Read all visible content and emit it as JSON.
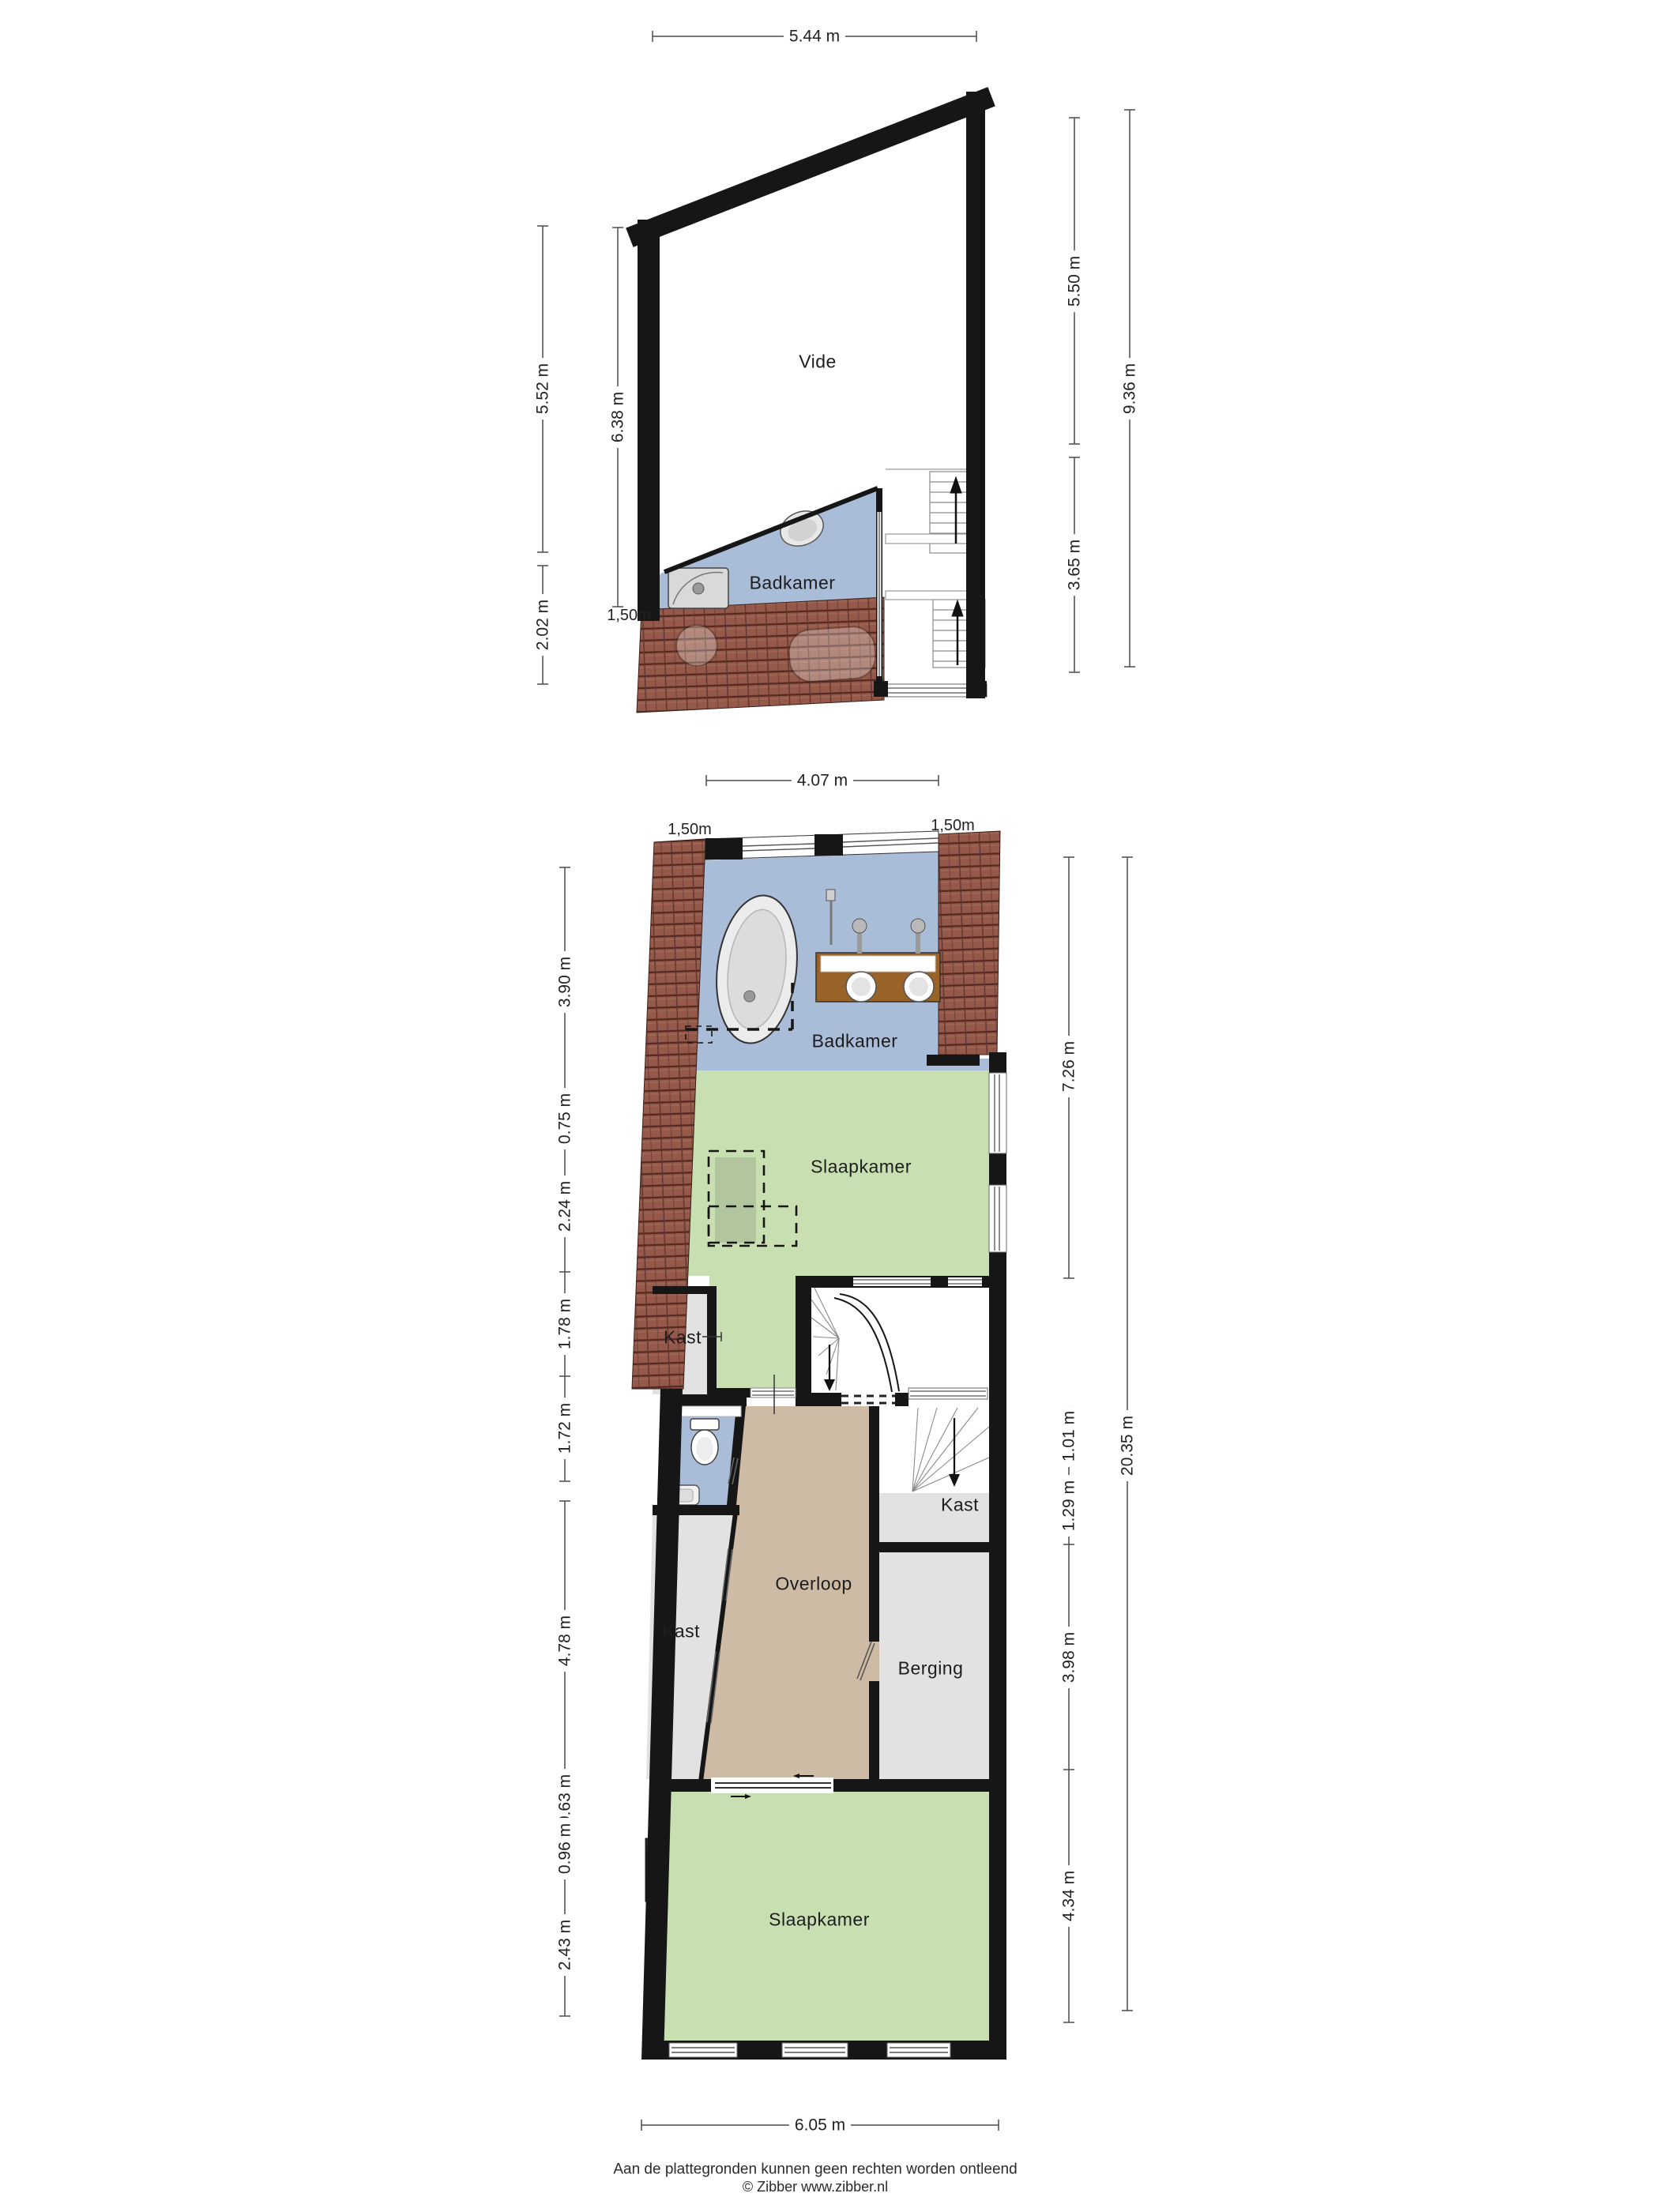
{
  "plan1": {
    "title": "attic floor plan",
    "rooms": {
      "vide": "Vide",
      "badkamer": "Badkamer"
    },
    "dims": {
      "top": "5.44 m",
      "left_a": "5.52 m",
      "left_b": "6.38 m",
      "left_c": "2.02 m",
      "left_small": "1,50m",
      "right_a": "5.50 m",
      "right_b": "3.65 m",
      "right_total": "9.36 m"
    }
  },
  "plan2": {
    "title": "first floor plan",
    "rooms": {
      "badkamer": "Badkamer",
      "slaapkamer_boven": "Slaapkamer",
      "kast_links_boven": "Kast",
      "kast_rechts": "Kast",
      "kast_links_onder": "Kast",
      "overloop": "Overloop",
      "berging": "Berging",
      "slaapkamer_onder": "Slaapkamer"
    },
    "dims": {
      "top": "4.07 m",
      "top_left_small": "1,50m",
      "top_right_small": "1,50m",
      "left": [
        "3.90 m",
        "0.75 m",
        "2.24 m",
        "1.78 m",
        "1.72 m",
        "4.78 m",
        "0.63 m",
        "0.96 m",
        "2.43 m"
      ],
      "right": [
        "7.26 m",
        "1.01 m",
        "1.29 m",
        "3.98 m",
        "4.34 m"
      ],
      "right_total": "20.35 m",
      "bottom": "6.05 m"
    }
  },
  "footer": {
    "line1": "Aan de plattegronden kunnen geen rechten worden ontleend",
    "line2": "© Zibber www.zibber.nl"
  },
  "colors": {
    "wall": "#161616",
    "bathroom_floor": "#a9bdd8",
    "bedroom_floor": "#c8e0b1",
    "landing_floor": "#cdbba6",
    "closet_floor": "#e2e2e2",
    "roof_tiles": "#94594a",
    "vanity_wood": "#996227",
    "chimney": "#6f6f6f"
  }
}
